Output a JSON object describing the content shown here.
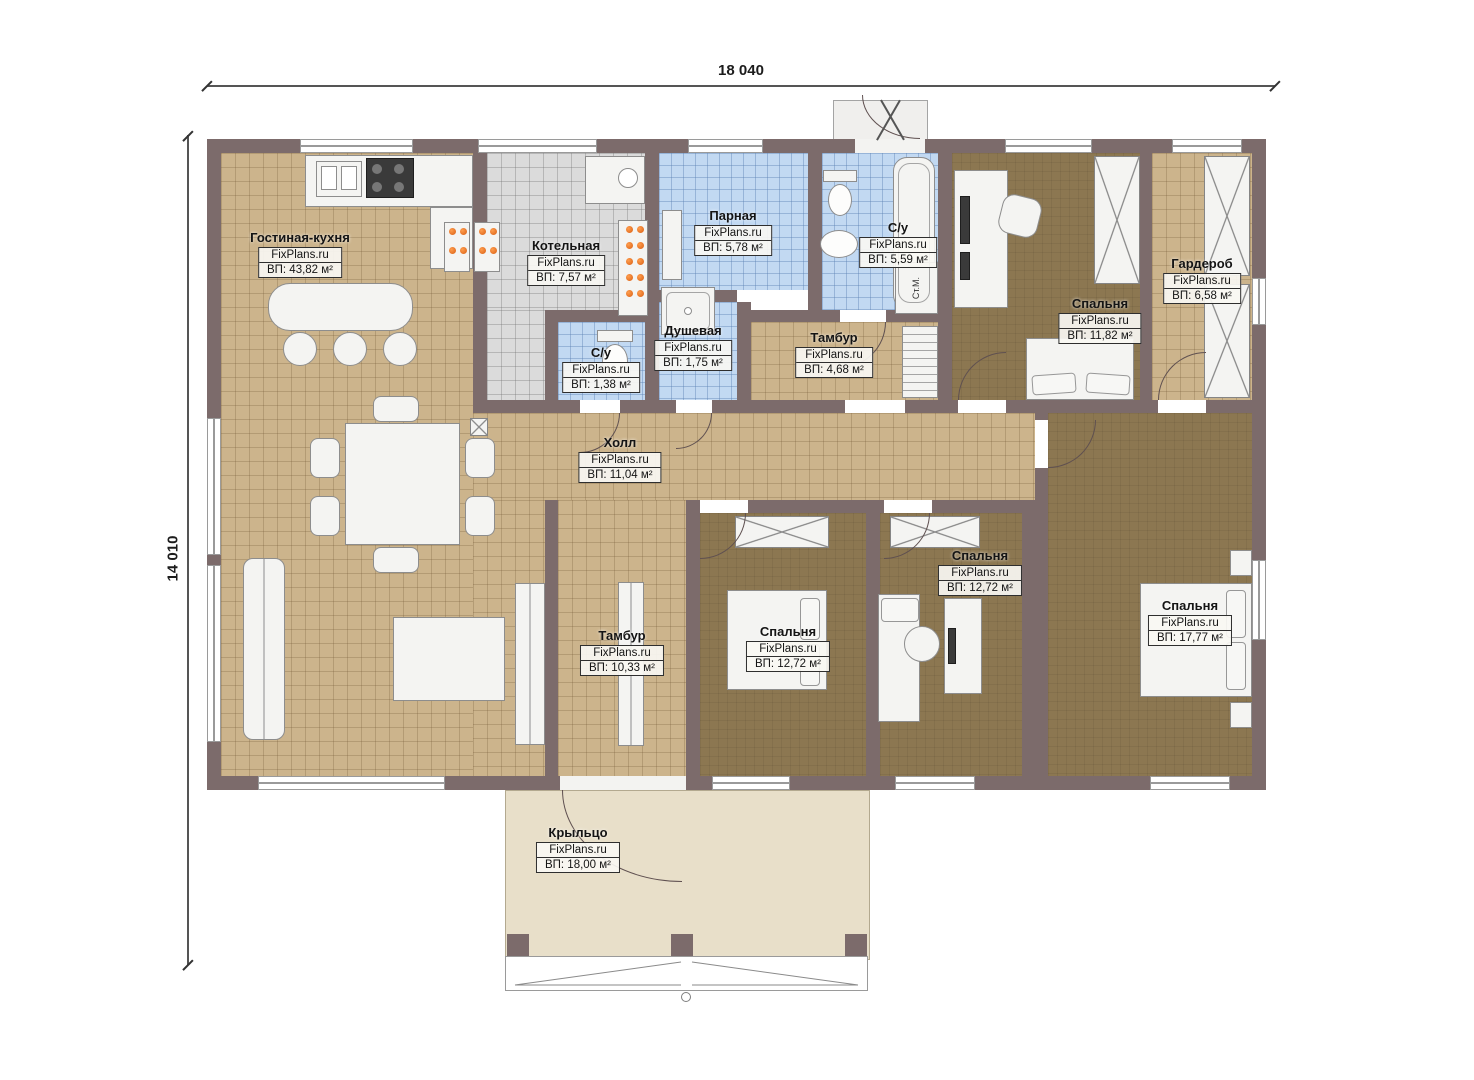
{
  "dimensions": {
    "width_label": "18 040",
    "height_label": "14 010"
  },
  "rooms": [
    {
      "name": "Гостиная-кухня",
      "brand": "FixPlans.ru",
      "area": "ВП: 43,82 м²"
    },
    {
      "name": "Котельная",
      "brand": "FixPlans.ru",
      "area": "ВП: 7,57 м²"
    },
    {
      "name": "Парная",
      "brand": "FixPlans.ru",
      "area": "ВП: 5,78 м²"
    },
    {
      "name": "С/у",
      "brand": "FixPlans.ru",
      "area": "ВП: 5,59 м²"
    },
    {
      "name": "Душевая",
      "brand": "FixPlans.ru",
      "area": "ВП: 1,75 м²"
    },
    {
      "name": "С/у",
      "brand": "FixPlans.ru",
      "area": "ВП: 1,38 м²"
    },
    {
      "name": "Тамбур",
      "brand": "FixPlans.ru",
      "area": "ВП: 4,68 м²"
    },
    {
      "name": "Спальня",
      "brand": "FixPlans.ru",
      "area": "ВП: 11,82 м²"
    },
    {
      "name": "Гардероб",
      "brand": "FixPlans.ru",
      "area": "ВП: 6,58 м²"
    },
    {
      "name": "Холл",
      "brand": "FixPlans.ru",
      "area": "ВП: 11,04 м²"
    },
    {
      "name": "Тамбур",
      "brand": "FixPlans.ru",
      "area": "ВП: 10,33 м²"
    },
    {
      "name": "Спальня",
      "brand": "FixPlans.ru",
      "area": "ВП: 12,72 м²"
    },
    {
      "name": "Спальня",
      "brand": "FixPlans.ru",
      "area": "ВП: 12,72 м²"
    },
    {
      "name": "Спальня",
      "brand": "FixPlans.ru",
      "area": "ВП: 17,77 м²"
    },
    {
      "name": "Крыльцо",
      "brand": "FixPlans.ru",
      "area": "ВП: 18,00 м²"
    }
  ],
  "annotations": {
    "washing_machine": "Ст.М."
  },
  "colors": {
    "wall": "#7c6b6b",
    "floor_tan": "#ccb48c",
    "floor_brown": "#8c7751",
    "floor_blue": "#c2d9f2",
    "floor_gray": "#dbdbdb",
    "porch": "#e8dfc9",
    "accent_orange": "#e8762a"
  }
}
